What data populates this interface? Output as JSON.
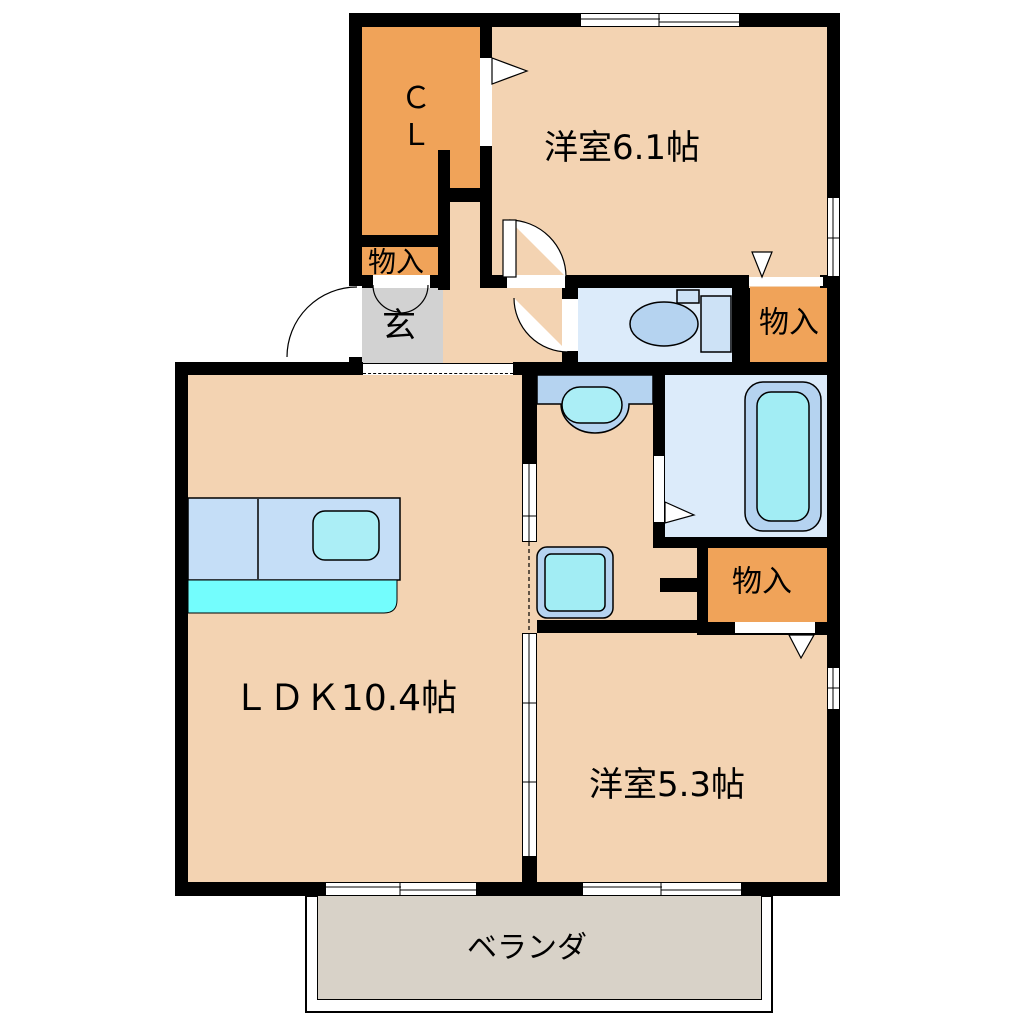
{
  "plan": {
    "labels": {
      "closet": "ＣＬ",
      "room_west_61": "洋室6.1帖",
      "storage_top": "物入",
      "entrance": "玄",
      "storage_mid": "物入",
      "storage_low": "物入",
      "ldk": "ＬＤＫ10.4帖",
      "room_west_53": "洋室5.3帖",
      "veranda": "ベランダ"
    },
    "colors": {
      "wall": "#000000",
      "room_floor": "#f3d3b2",
      "closet_fill": "#f0a359",
      "entrance_fill": "#d2d2d2",
      "wet_room_fill": "#dcebfa",
      "fixture_blue": "#b5d3f0",
      "fixture_light_blue": "#cde2f6",
      "fixture_cyan": "#a2edf4",
      "sink_cyan": "#abeef6",
      "kitchen_counter": "#c5def7",
      "kitchen_strip": "#73fdfd",
      "veranda_fill": "#d8d2c8"
    }
  }
}
